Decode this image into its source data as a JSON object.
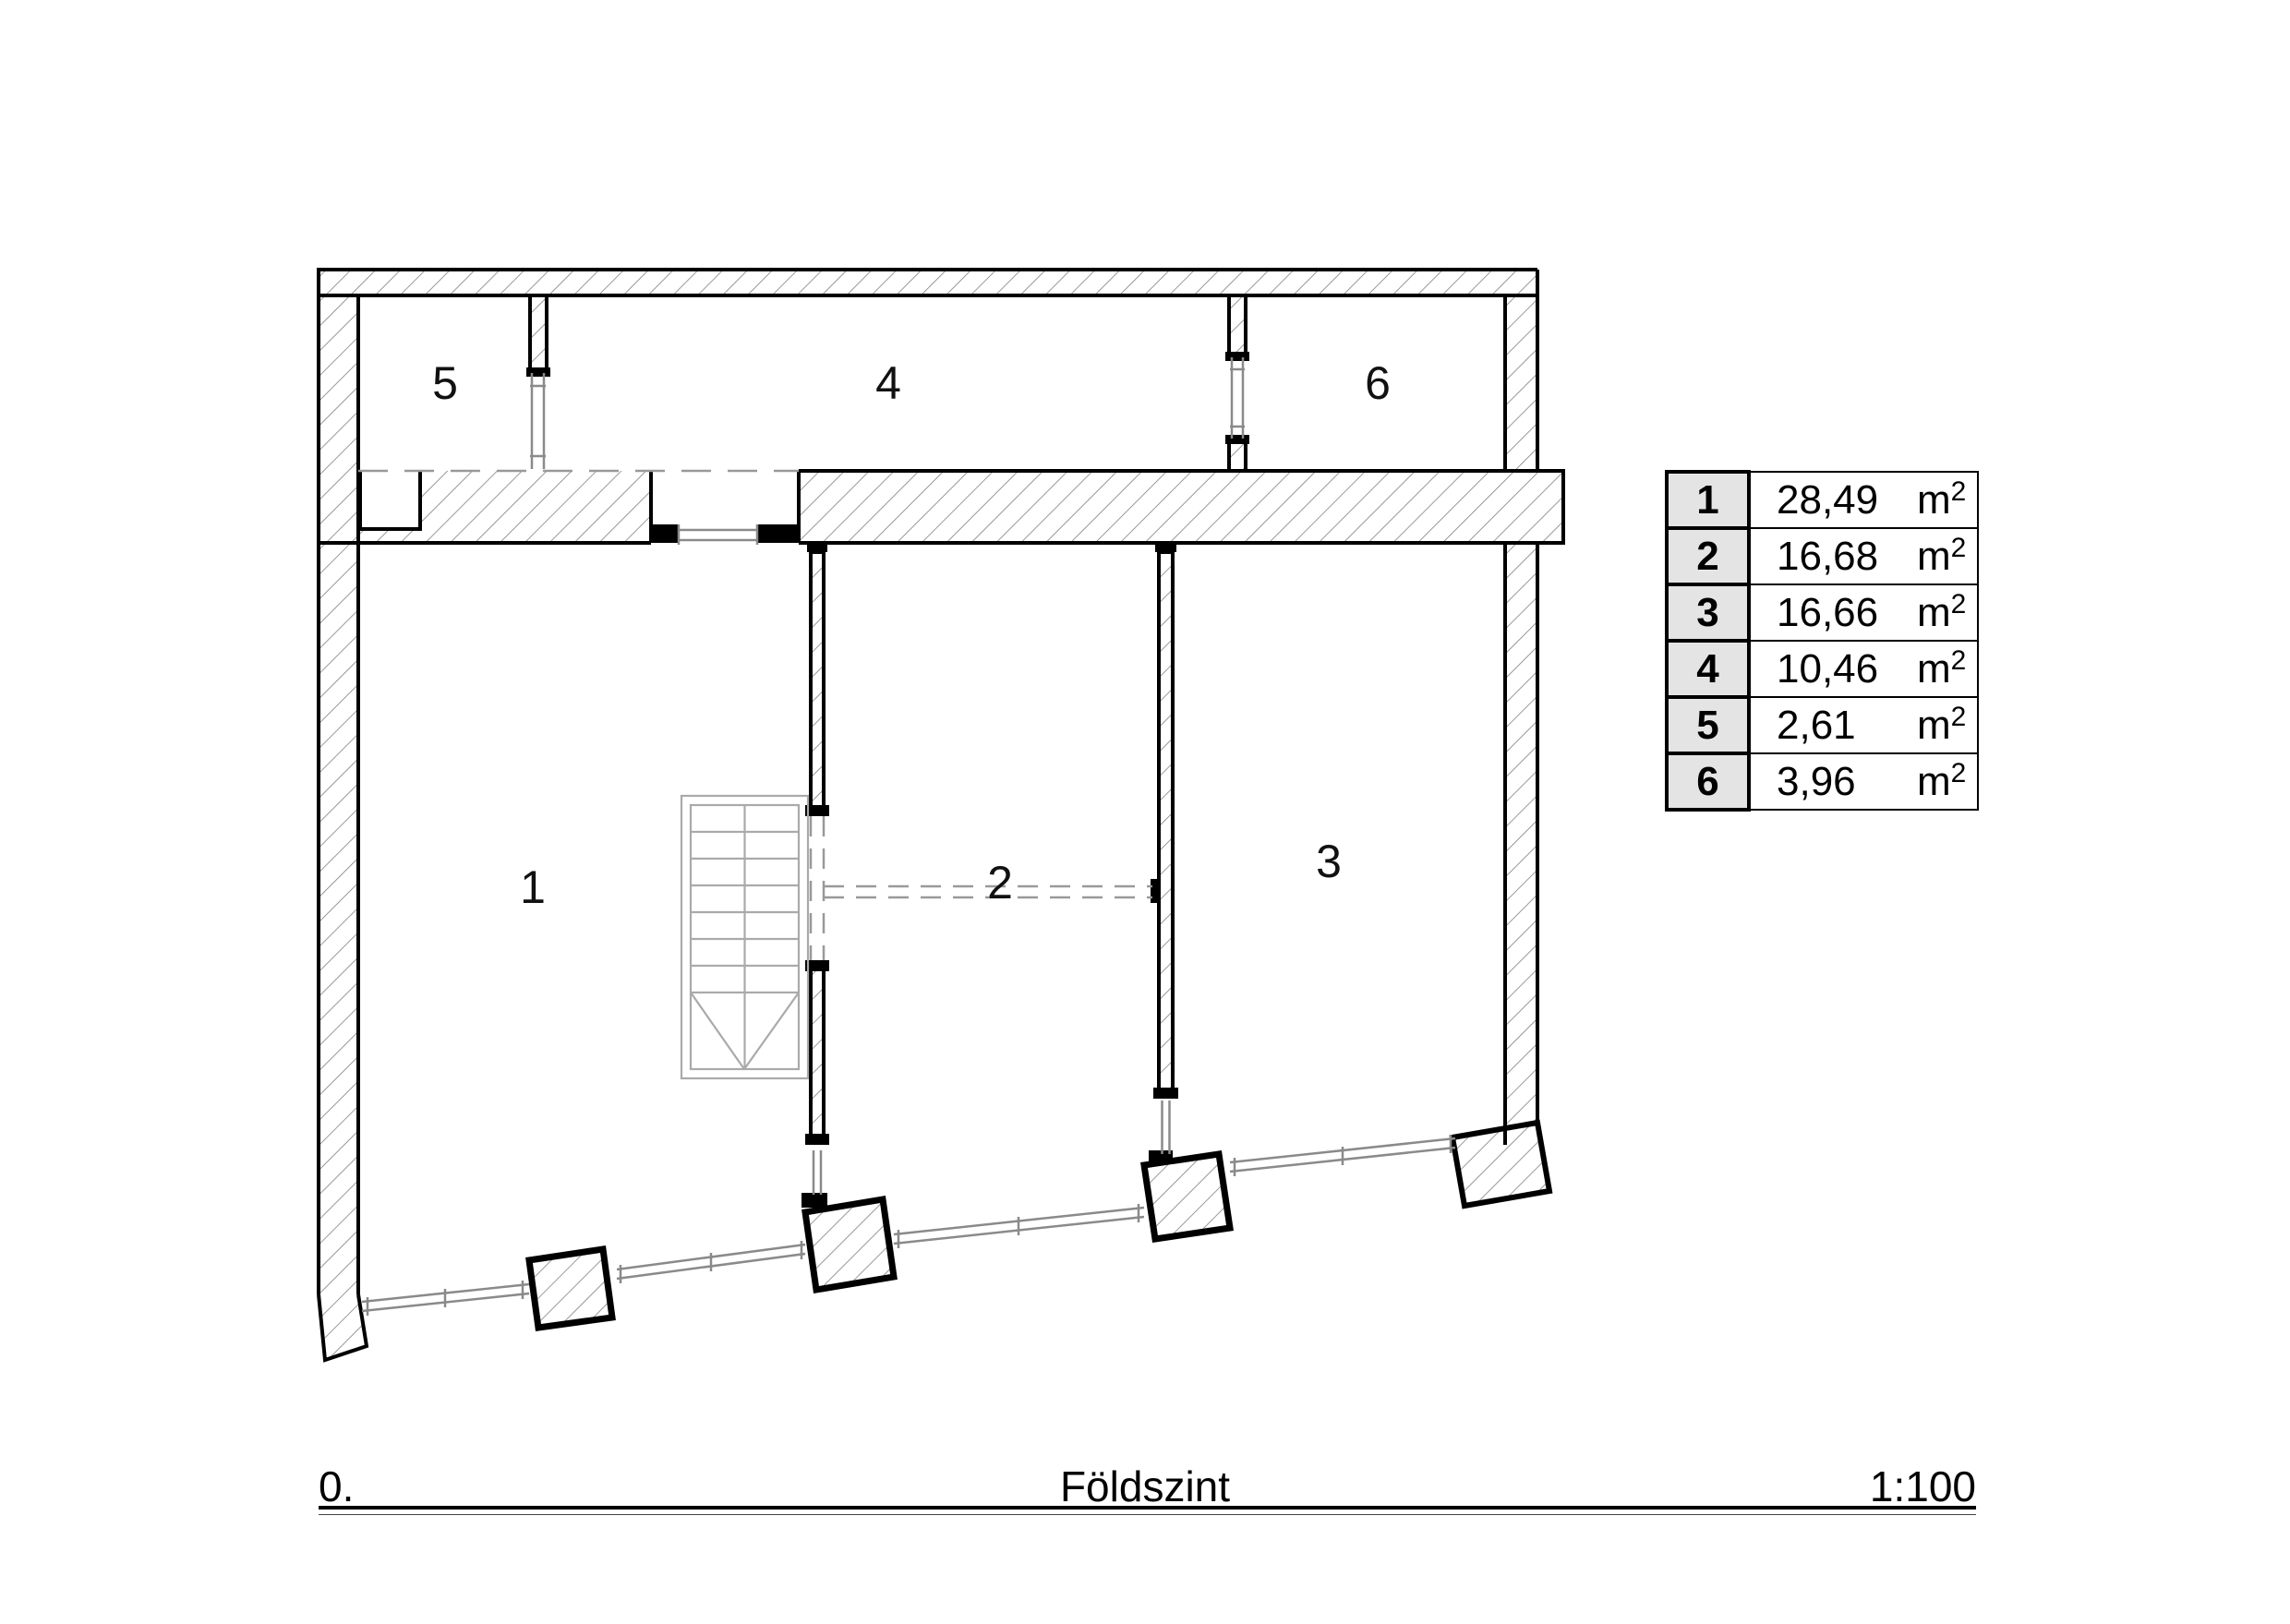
{
  "drawing": {
    "scale_label": "1:100",
    "level_number": "0.",
    "level_name": "Földszint",
    "unit": "m",
    "unit_sup": "2",
    "rooms": [
      {
        "id": "1",
        "area": "28,49"
      },
      {
        "id": "2",
        "area": "16,68"
      },
      {
        "id": "3",
        "area": "16,66"
      },
      {
        "id": "4",
        "area": "10,46"
      },
      {
        "id": "5",
        "area": "2,61"
      },
      {
        "id": "6",
        "area": "3,96"
      }
    ],
    "colors": {
      "outline": "#000000",
      "hatch": "#7f7f7f",
      "window": "#8a8a8a",
      "stair": "#aaaaaa",
      "dashed": "#999999",
      "table_num_bg": "#e4e4e4"
    }
  }
}
